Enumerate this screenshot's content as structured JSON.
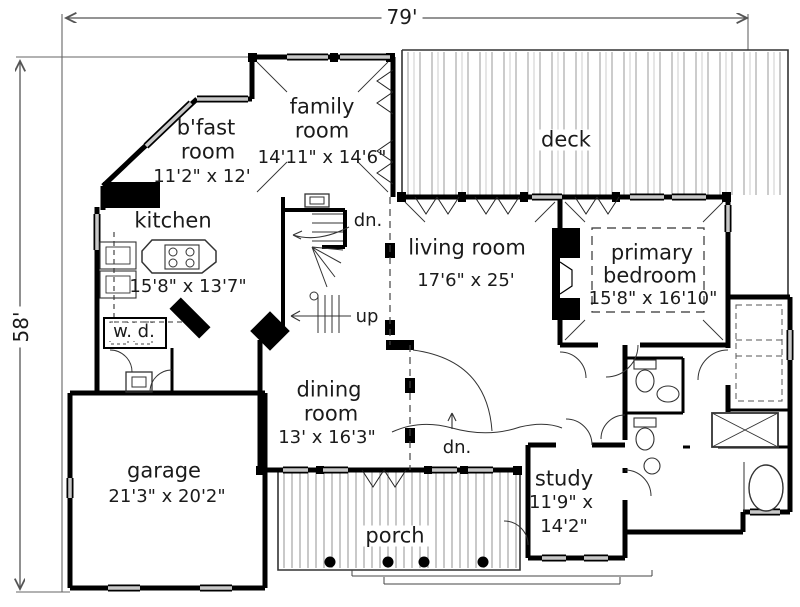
{
  "dimensions": {
    "width": "79'",
    "height": "58'"
  },
  "rooms": {
    "family": {
      "line1": "family",
      "line2": "room",
      "size": "14'11\" x 14'6\""
    },
    "bfast": {
      "line1": "b'fast",
      "line2": "room",
      "size": "11'2\" x 12'"
    },
    "deck": {
      "name": "deck"
    },
    "kitchen": {
      "name": "kitchen",
      "size": "15'8\" x 13'7\""
    },
    "living": {
      "name": "living room",
      "size": "17'6\" x 25'"
    },
    "primary": {
      "line1": "primary",
      "line2": "bedroom",
      "size": "15'8\" x 16'10\""
    },
    "laundry": {
      "name": "w. d."
    },
    "dining": {
      "line1": "dining",
      "line2": "room",
      "size": "13' x 16'3\""
    },
    "garage": {
      "name": "garage",
      "size": "21'3\" x 20'2\""
    },
    "study": {
      "name": "study",
      "size_line1": "11'9\" x",
      "size_line2": "14'2\""
    },
    "porch": {
      "name": "porch"
    }
  },
  "annotations": {
    "stairs_down": "dn.",
    "stairs_up": "up",
    "porch_down": "dn."
  }
}
